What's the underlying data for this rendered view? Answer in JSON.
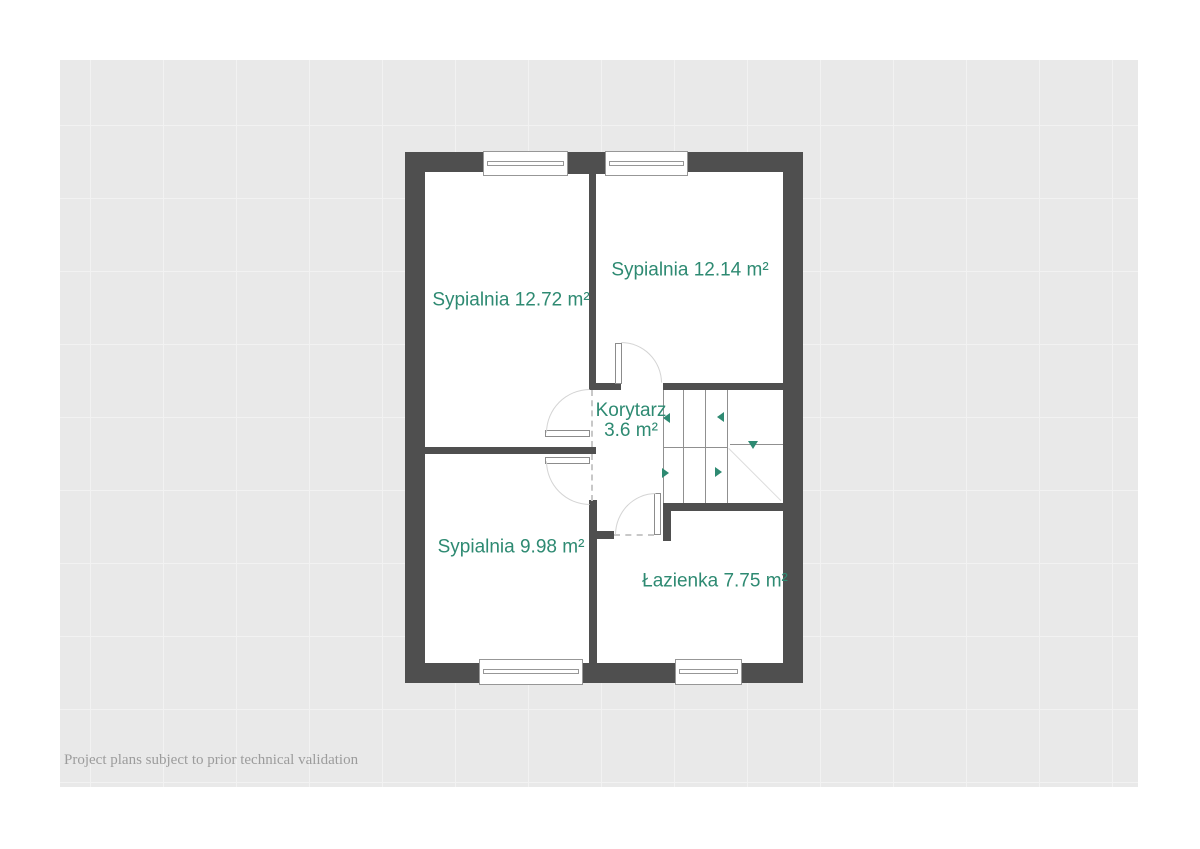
{
  "page": {
    "background": "#ffffff",
    "canvas_background": "#e9e9e9",
    "grid_line_color": "#f2f2f2"
  },
  "colors": {
    "wall": "#4f4f4f",
    "room_floor": "#ffffff",
    "room_label": "#2e8a72",
    "stair_arrow": "#2e8a72",
    "door_arc": "#d4d4d4",
    "footer_text": "#9c9c9c"
  },
  "rooms": [
    {
      "id": "bedroom-top-left",
      "label": "Sypialnia 12.72 m²"
    },
    {
      "id": "bedroom-top-right",
      "label": "Sypialnia 12.14 m²"
    },
    {
      "id": "hallway",
      "name": "Korytarz",
      "area": "3.6 m²"
    },
    {
      "id": "bedroom-bottom-left",
      "label": "Sypialnia 9.98 m²"
    },
    {
      "id": "bathroom",
      "label": "Łazienka 7.75 m²"
    }
  ],
  "footer": {
    "disclaimer": "Project plans subject to prior technical validation"
  }
}
